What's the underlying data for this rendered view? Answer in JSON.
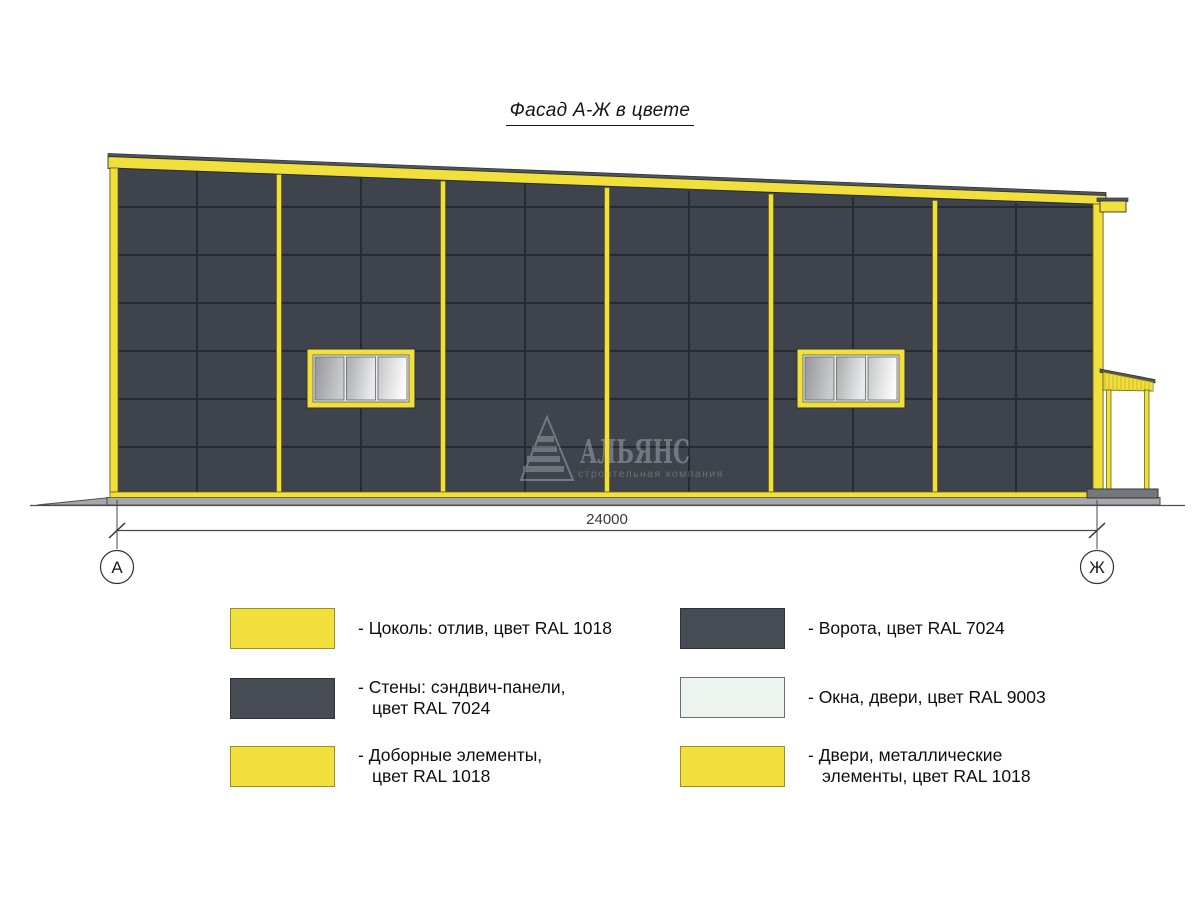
{
  "title": "Фасад А-Ж в цвете",
  "colors": {
    "ral_1018_yellow": "#F1DF3B",
    "ral_7024_wall": "#3E434C",
    "ral_9003_white": "#EDF3EE",
    "legend_dark_swatch": "#474C54",
    "ground_gray": "#A6A8AA",
    "dimension_line": "#4A4A4A"
  },
  "dimension": {
    "value": "24000",
    "axis_left": "А",
    "axis_right": "Ж"
  },
  "watermark": {
    "name": "АЛЬЯНС",
    "subtitle": "строительная компания"
  },
  "legend": {
    "items": [
      {
        "swatch": "yellow",
        "line1": "- Цоколь: отлив, цвет RAL 1018",
        "line2": ""
      },
      {
        "swatch": "dark",
        "line1": "- Стены: сэндвич-панели,",
        "line2": "цвет RAL 7024"
      },
      {
        "swatch": "yellow",
        "line1": "- Доборные элементы,",
        "line2": "цвет RAL 1018"
      },
      {
        "swatch": "dark",
        "line1": "- Ворота, цвет RAL 7024",
        "line2": ""
      },
      {
        "swatch": "white",
        "line1": "- Окна, двери, цвет RAL 9003",
        "line2": ""
      },
      {
        "swatch": "yellow",
        "line1": "- Двери, металлические",
        "line2": "элементы, цвет RAL 1018"
      }
    ]
  }
}
